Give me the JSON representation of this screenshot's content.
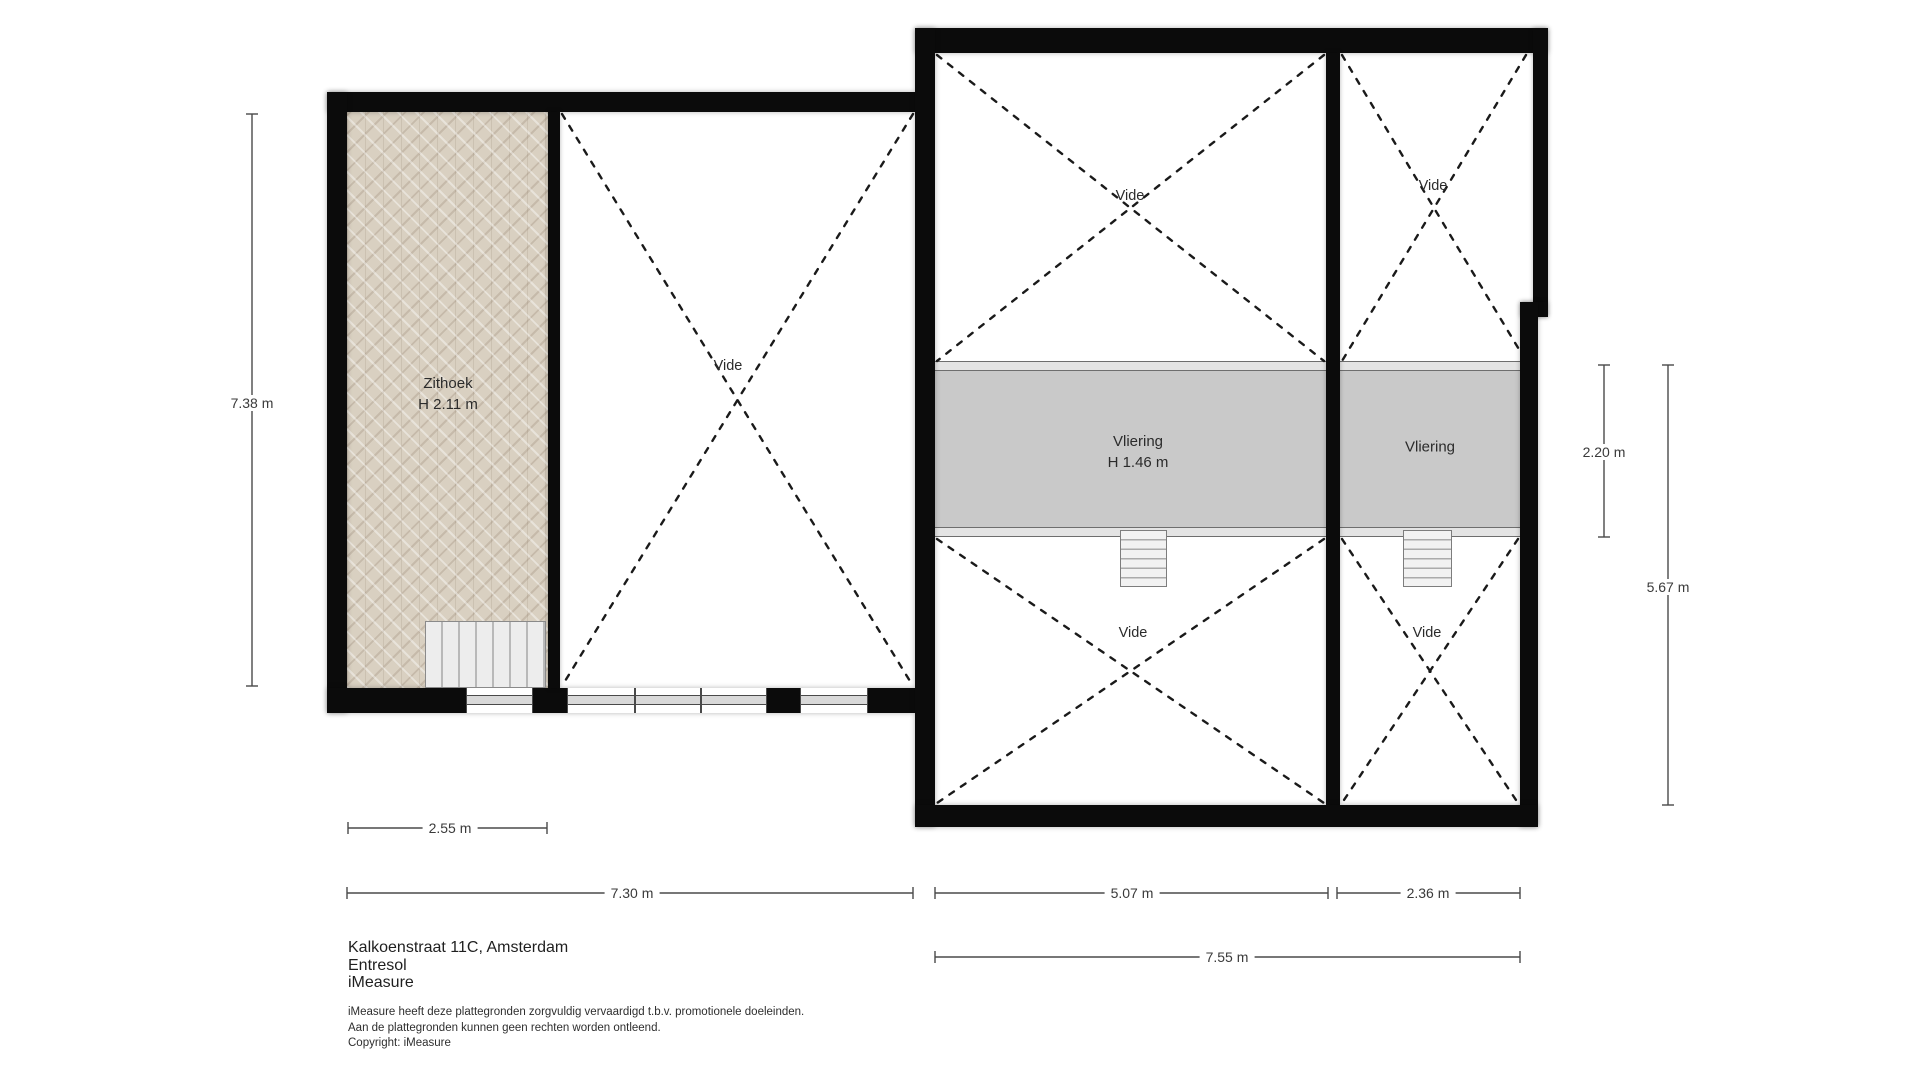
{
  "document_type": "floorplan",
  "colors": {
    "wall": "#0b0b0b",
    "vliering_fill": "#c9c9c9",
    "ledge_fill": "#e4e4e4",
    "wood_floor_fill": "#d9d0c1",
    "dashed_line": "#1a1a1a",
    "dimension_line": "#4a4a4a",
    "text": "#2b2b2b",
    "background": "#ffffff"
  },
  "rooms": {
    "zithoek": {
      "label": "Zithoek",
      "height_label": "H 2.11 m"
    },
    "vide_left_building": {
      "label": "Vide"
    },
    "vide_top_left": {
      "label": "Vide"
    },
    "vide_top_right": {
      "label": "Vide"
    },
    "vide_bottom_left": {
      "label": "Vide"
    },
    "vide_bottom_right": {
      "label": "Vide"
    },
    "vliering_left": {
      "label": "Vliering",
      "height_label": "H 1.46 m"
    },
    "vliering_right": {
      "label": "Vliering"
    }
  },
  "dimensions": {
    "left_building_height": "7.38 m",
    "zithoek_width": "2.55 m",
    "left_building_width": "7.30 m",
    "right_section_a_width": "5.07 m",
    "right_section_b_width": "2.36 m",
    "right_building_width": "7.55 m",
    "vliering_depth": "2.20 m",
    "right_building_height": "5.67 m"
  },
  "title_block": {
    "address": "Kalkoenstraat 11C, Amsterdam",
    "floor": "Entresol",
    "company": "iMeasure",
    "disclaimer_line1": "iMeasure heeft deze plattegronden zorgvuldig vervaardigd t.b.v. promotionele doeleinden.",
    "disclaimer_line2": "Aan de plattegronden kunnen geen rechten worden ontleend.",
    "disclaimer_line3": "Copyright: iMeasure"
  }
}
